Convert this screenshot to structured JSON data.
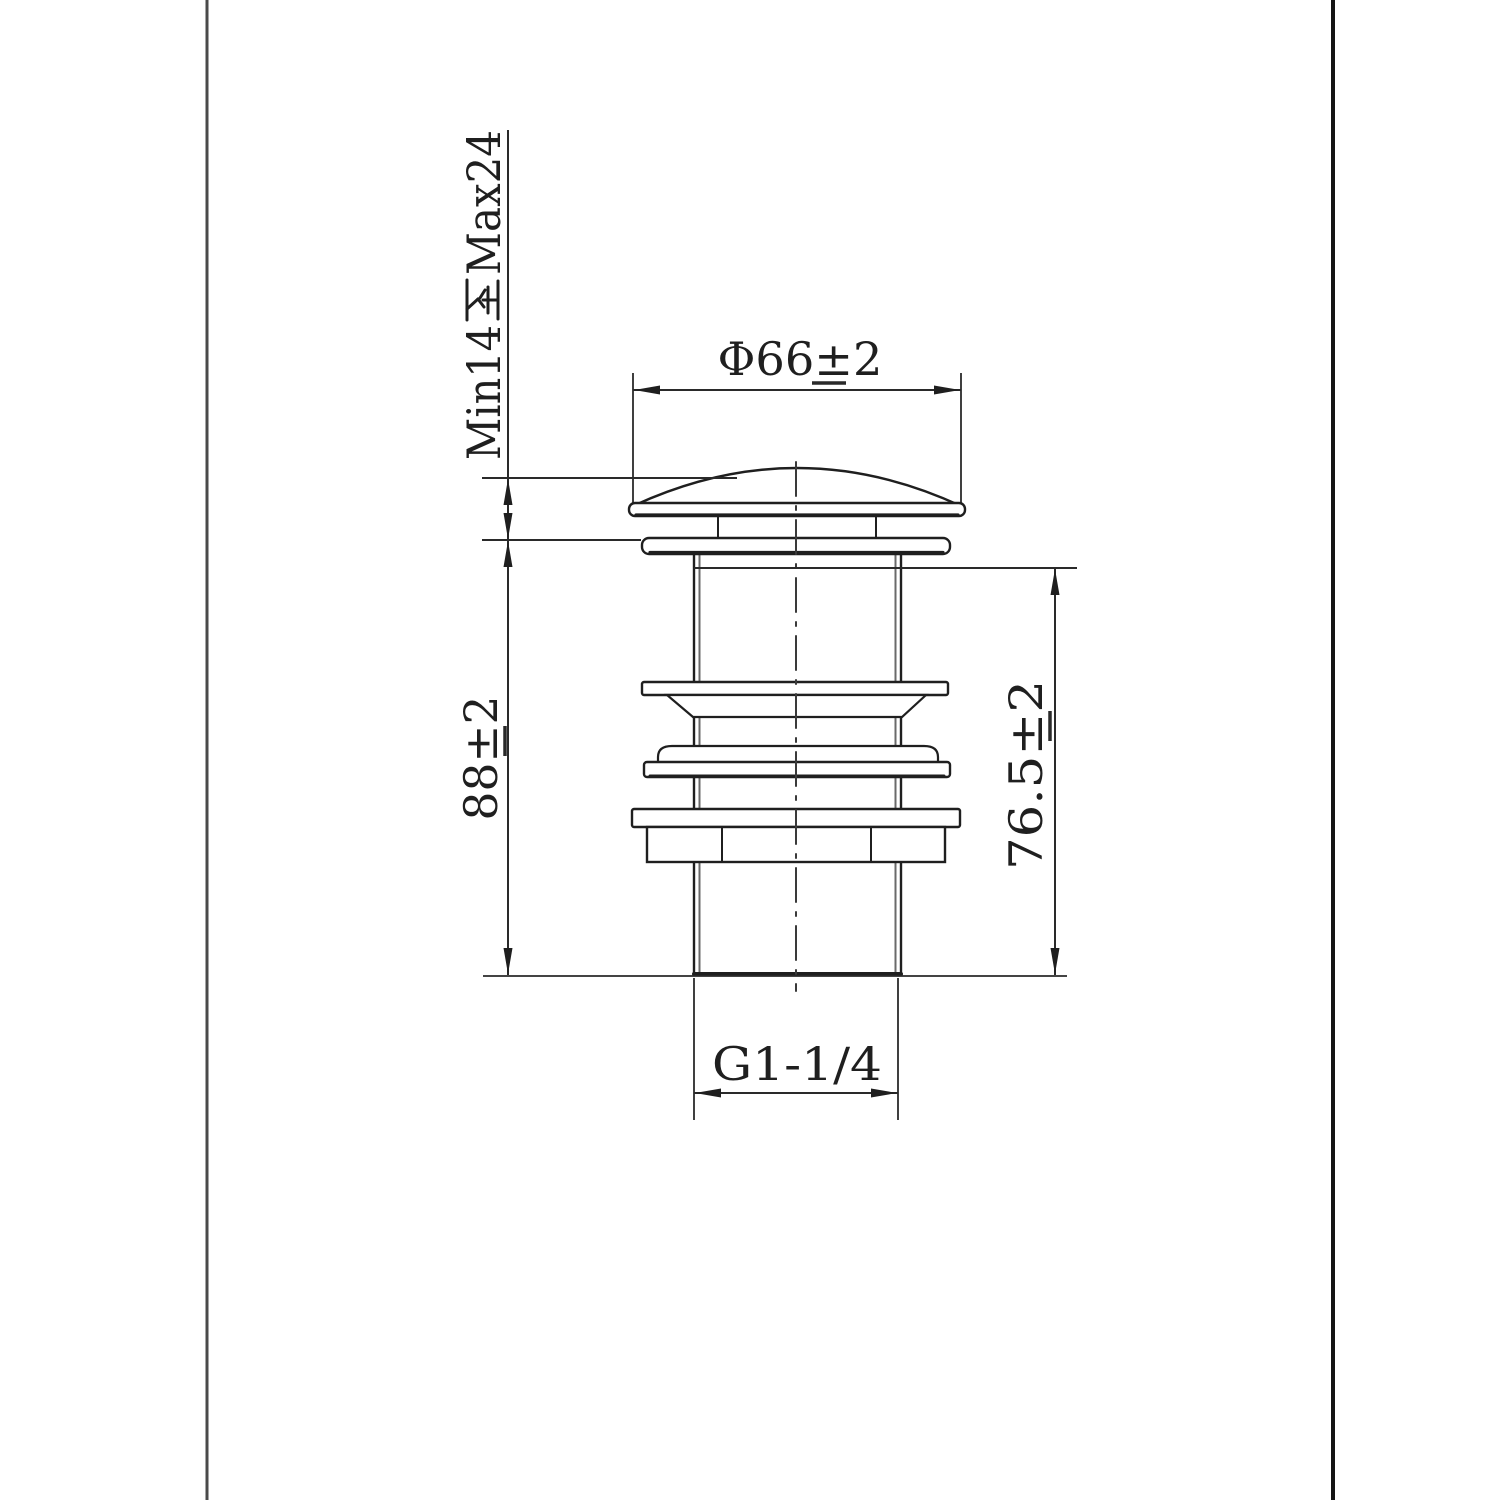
{
  "sheet": {
    "description": "Technical section drawing of a pop-up basin waste drain fitting with dimension annotations",
    "line_color": "#1f1f1f",
    "background": "#ffffff"
  },
  "dimensions": {
    "cap_diameter": "Φ66±2",
    "cap_travel": {
      "full": "Min14至Max24",
      "prefix": "Min14",
      "cjk_char": "至",
      "suffix": "Max24"
    },
    "overall_height": "88±2",
    "thread_length": "76.5±2",
    "thread_spec": "G1-1/4"
  }
}
